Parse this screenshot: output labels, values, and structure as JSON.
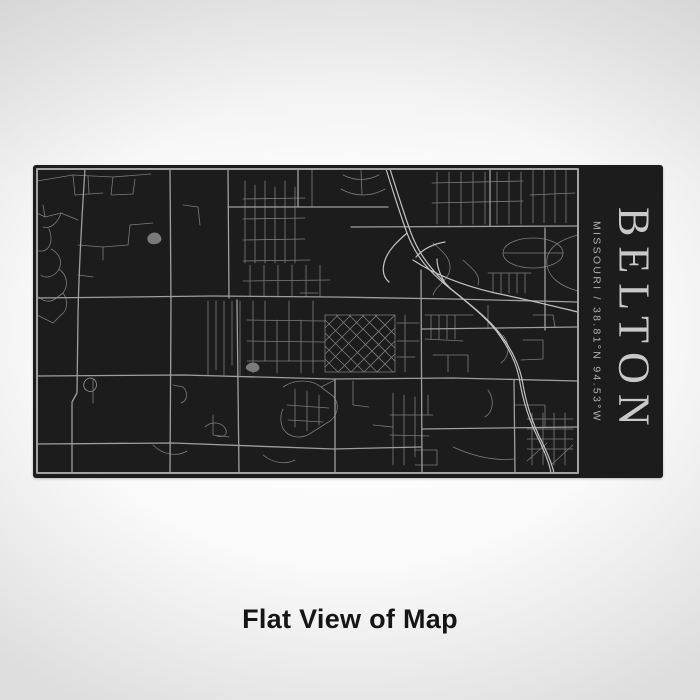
{
  "page": {
    "caption": "Flat View of Map",
    "background_edge_color": "#dedede",
    "background_center_color": "#ffffff"
  },
  "product": {
    "title": "BELTON",
    "subtitle": "MISSOURI / 38.81°N 94.53°W",
    "panel_color": "#1c1c1d",
    "title_color": "#c9c9c9",
    "subtitle_color": "#afafaf"
  },
  "map": {
    "region": "Belton, Missouri street map engraving",
    "frame_color": "#a3a3a3",
    "layers": [
      {
        "name": "minor-roads",
        "color": "#7c7c7c",
        "width": 0.8,
        "fill": false,
        "paths": [
          "M4,16 L40,10 L80,12 L118,9",
          "M40,10 L42,30 L70,28",
          "M80,12 L78,30 L100,29",
          "M100,29 L102,14",
          "M55,11 L56,29",
          "M45,55 L28,48 L12,52 L4,48",
          "M28,48 C24,60 16,64 10,62",
          "M16,64 C20,74 18,84 10,86 L4,86",
          "M18,84 C26,88 30,96 26,104 C22,112 12,114 8,110",
          "M26,104 C34,110 36,120 30,128 L22,134",
          "M22,134 C16,138 10,136 6,132",
          "M30,128 C36,136 34,146 28,150",
          "M12,52 L10,40",
          "M4,150 L20,158 L28,150",
          "M45,80 L70,82 L70,95",
          "M70,82 L95,80 L97,60 L120,58",
          "M45,110 L60,112",
          "M310,10 C322,16 334,16 346,10",
          "M308,24 C322,32 338,32 352,24",
          "M328,4 L329,30",
          "M279,4 L279,42",
          "M150,40 L165,42 L167,60",
          "M175,136 L175,210",
          "M183,136 L183,205",
          "M191,136 L191,210",
          "M199,136 L199,200",
          "M207,136 L207,210",
          "M212,16 L212,98",
          "M222,20 L222,98",
          "M232,16 L232,98",
          "M242,22 L242,98",
          "M252,16 L252,98",
          "M262,22 L262,98",
          "M210,34 L272,33",
          "M210,54 L272,53",
          "M210,75 L272,74",
          "M210,96 L277,95",
          "M217,100 L217,132",
          "M231,100 L231,132",
          "M245,100 L245,132",
          "M259,100 L259,132",
          "M273,100 L273,132",
          "M287,100 L287,132",
          "M210,116 L297,115",
          "M267,128 L285,128",
          "M292,150 L292,207",
          "M292,207 L362,207",
          "M362,150 L362,207",
          "M292,150 L362,150",
          "M292,155 L344,207",
          "M292,168 L331,207",
          "M292,181 L318,207",
          "M292,194 L305,207",
          "M303,150 L360,207",
          "M316,150 L362,196",
          "M329,150 L362,183",
          "M342,150 L362,170",
          "M292,202 L344,150",
          "M292,189 L331,150",
          "M292,176 L318,150",
          "M292,163 L305,150",
          "M305,207 L362,150",
          "M318,207 L362,163",
          "M331,207 L362,176",
          "M344,207 L362,189",
          "M214,155 L292,156",
          "M214,176 L292,177",
          "M214,196 L292,196",
          "M220,136 L220,208",
          "M232,136 L232,196",
          "M244,155 L244,208",
          "M256,136 L256,196",
          "M268,155 L268,208",
          "M280,136 L280,208",
          "M364,158 L386,158",
          "M364,176 L386,176",
          "M372,150 L372,207",
          "M364,192 L382,192",
          "M392,150 L440,150",
          "M398,150 L398,174",
          "M406,150 L406,174",
          "M414,150 L414,174",
          "M422,150 L422,174",
          "M392,174 L430,176",
          "M400,190 L435,190 L435,207",
          "M415,190 L415,207",
          "M455,140 L455,164",
          "M470,170 C478,180 476,192 468,198",
          "M490,175 L510,175 L510,194 L488,195",
          "M500,150 L520,150 L522,162",
          "M399,18 L490,16",
          "M399,38 L490,36",
          "M404,7 L404,59",
          "M416,7 L416,59",
          "M428,7 L428,59",
          "M440,7 L440,59",
          "M452,7 L452,59",
          "M464,7 L464,59",
          "M476,7 L476,59",
          "M488,7 L488,59",
          "M500,5 L500,58",
          "M511,5 L511,58",
          "M522,5 L522,58",
          "M533,5 L533,58",
          "M497,30 L542,28",
          "M470,88 C470,79 484,73 500,73 C516,73 530,79 530,88 C530,97 516,103 500,103 C484,103 470,97 470,88",
          "M470,88 L530,88",
          "M460,108 L460,128",
          "M468,108 L468,128",
          "M476,108 L476,128",
          "M484,108 L484,128",
          "M492,108 L492,128",
          "M455,108 L498,108",
          "M545,70 C522,76 512,86 514,100 C516,114 530,122 545,126",
          "M400,78 C412,88 420,96 416,108 C412,118 402,122 400,130",
          "M430,95 C440,104 448,110 445,120",
          "M250,222 C262,214 278,214 288,222 L300,231 C307,239 305,250 297,256 L278,268 C268,275 256,272 251,265 C247,259 247,250 250,244",
          "M262,224 L262,262",
          "M274,226 L274,266",
          "M286,230 L286,260",
          "M254,240 L296,243",
          "M255,255 L290,257",
          "M288,222 L302,215",
          "M360,228 L360,300",
          "M371,230 L371,300",
          "M382,232 L382,292",
          "M357,250 L400,250",
          "M357,270 L396,271",
          "M382,285 L404,285 L404,300 L382,300",
          "M395,230 L395,250",
          "M494,254 L540,254",
          "M494,264 L540,264",
          "M494,274 L540,274",
          "M494,284 L540,284",
          "M499,248 L499,300",
          "M510,248 L510,300",
          "M521,248 L521,300",
          "M532,248 L532,300",
          "M494,296 L514,278",
          "M518,300 L540,280",
          "M120,280 C130,290 144,292 154,286",
          "M230,290 C240,298 252,300 262,295",
          "M180,250 L180,270 L196,272",
          "M320,216 L320,240 L336,242",
          "M340,260 L360,262",
          "M140,220 L150,222 C156,228 154,236 148,238",
          "M172,262 C178,256 188,257 192,263 C196,269 190,273 184,271",
          "M420,282 C442,292 462,296 481,294",
          "M60,215 L60,238",
          "M482,240 L512,240 L512,262",
          "M455,225 C462,235 460,247 452,252"
        ]
      },
      {
        "name": "major-roads",
        "color": "#9e9e9e",
        "width": 1.3,
        "fill": false,
        "paths": [
          "M52,4 C49,50 46,100 45,150 L44,228 L39,237 L39,308",
          "M137,4 L138,140 L137,308",
          "M195,4 L196,133",
          "M204,135 L206,308",
          "M4,133 L180,131 L300,132 L420,134 L545,137",
          "M4,211 L150,210 L300,214 L420,213 L545,216",
          "M4,279 L140,278 L300,284 L388,282",
          "M318,62 L545,61",
          "M389,164 L545,162",
          "M388,105 L389,308",
          "M457,4 L457,61",
          "M195,42 L355,42",
          "M389,264 L545,262",
          "M481,215 L482,308",
          "M512,63 L512,165",
          "M265,4 L265,42",
          "M302,215 L302,308"
        ]
      },
      {
        "name": "highway",
        "color": "#c2c2c2",
        "width": 1.2,
        "fill": false,
        "paths": [
          "M353,4 C360,26 366,46 374,68 C383,92 396,106 414,121 L424,129 C441,143 458,157 467,171 C477,185 483,198 486,212 C490,238 497,257 505,273 C511,285 516,297 518,308",
          "M357,4 C364,26 370,46 378,68 C387,92 400,106 418,124 L428,132 C445,146 461,159 470,173 C480,187 486,200 489,214 C493,240 500,259 508,275 C514,287 519,299 521,308",
          "M374,68 C365,76 356,84 352,95 C349,104 350,112 356,117",
          "M383,92 C390,84 400,79 412,77",
          "M380,95 C404,111 432,121 462,128 C492,134 520,141 545,147",
          "M414,121 C408,112 404,103 404,94"
        ]
      },
      {
        "name": "pond-outlines",
        "color": "#8a8a8a",
        "width": 0.9,
        "fill": false,
        "paths": [
          "M52,216 C55,212 61,212 63,217 C65,223 60,228 55,226 C50,224 50,219 52,216"
        ]
      },
      {
        "name": "pond-fills",
        "color": "#7a7a7a",
        "width": 0,
        "fill": true,
        "paths": [
          "M214,200 C218,196 224,197 226,201 C228,205 223,208 219,207 C214,206 211,203 214,200",
          "M116,70 C120,66 126,67 128,72 C130,77 124,80 119,79 C114,78 113,73 116,70"
        ]
      },
      {
        "name": "map-frame",
        "color": "#a3a3a3",
        "width": 2,
        "fill": false,
        "paths": [
          "M4,4 L545,4 L545,308 L4,308 Z"
        ]
      }
    ]
  }
}
